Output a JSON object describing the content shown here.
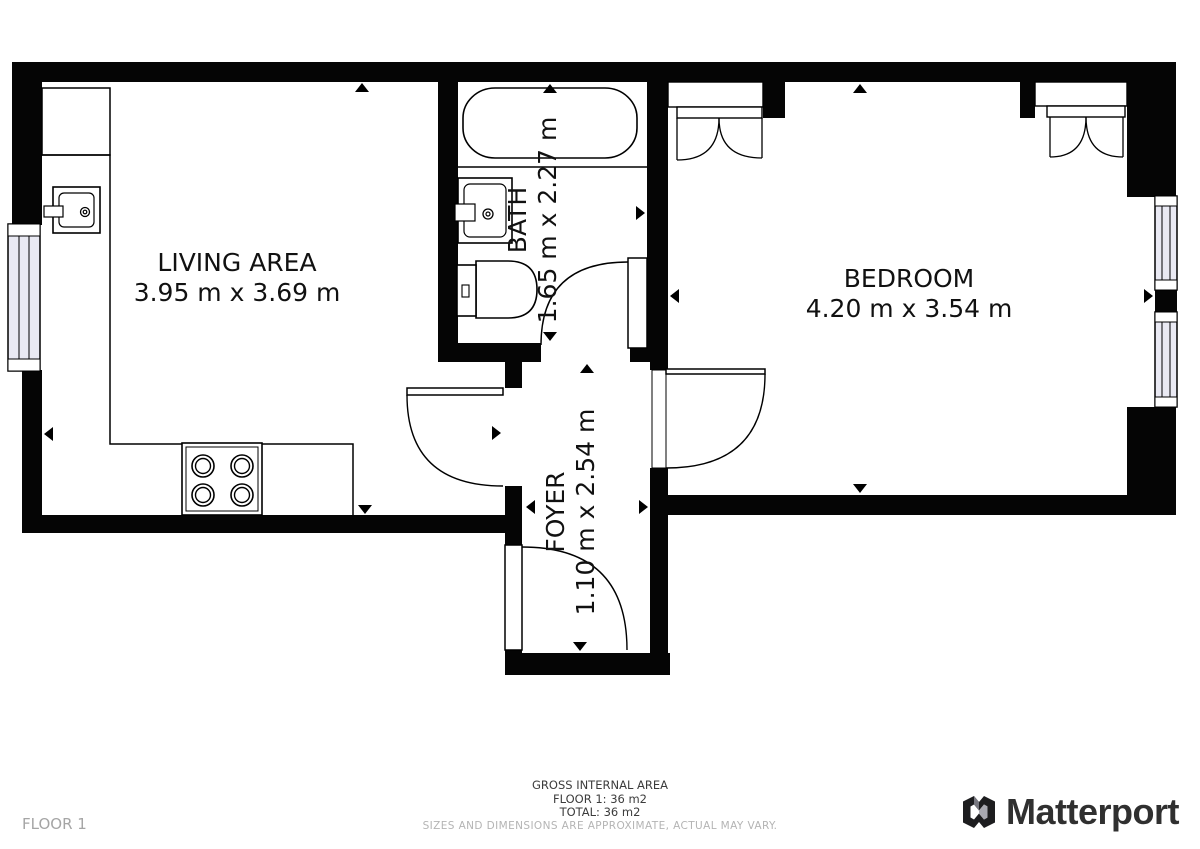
{
  "rooms": {
    "living": {
      "name": "LIVING AREA",
      "dims": "3.95 m x 3.69 m"
    },
    "bath": {
      "name": "BATH",
      "dims": "1.65 m x 2.27 m"
    },
    "bedroom": {
      "name": "BEDROOM",
      "dims": "4.20 m x 3.54 m"
    },
    "foyer": {
      "name": "FOYER",
      "dims": "1.10 m x 2.54 m"
    }
  },
  "footer": {
    "gross_label": "GROSS INTERNAL AREA",
    "floor_line": "FLOOR 1: 36 m2",
    "total_line": "TOTAL: 36 m2",
    "disclaimer": "SIZES AND DIMENSIONS ARE APPROXIMATE, ACTUAL MAY VARY."
  },
  "floor_label": "FLOOR 1",
  "brand": {
    "name": "Matterport"
  },
  "colors": {
    "wall": "#050505",
    "window_fill": "#e9e9f3",
    "label_text": "#111111",
    "muted_text": "#a5a5a5",
    "brand_text": "#303030"
  }
}
